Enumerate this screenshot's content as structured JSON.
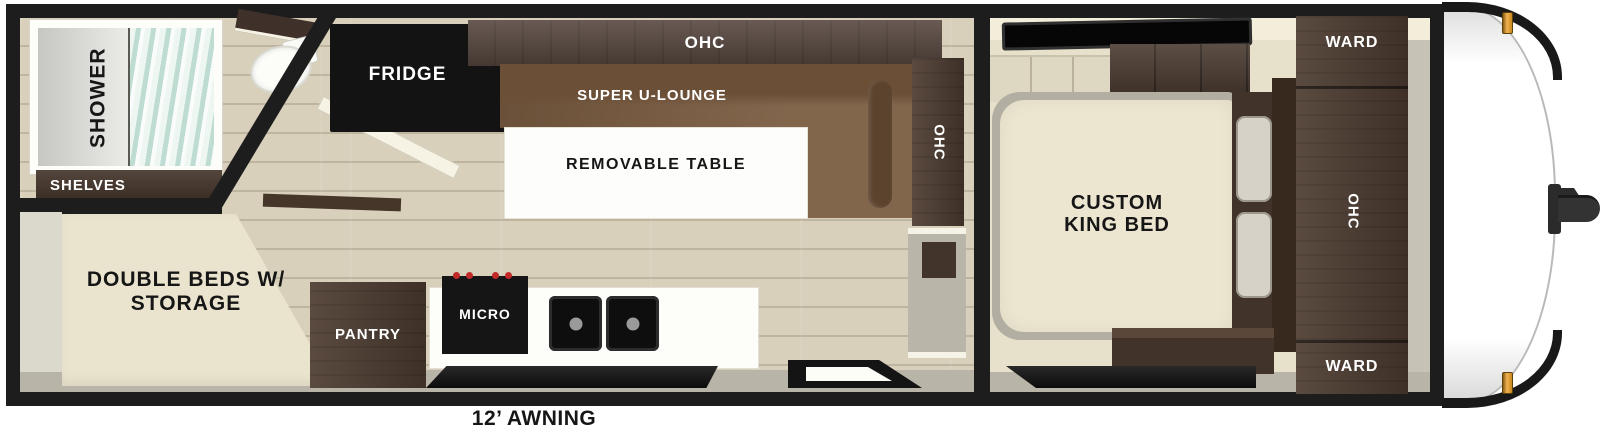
{
  "meta": {
    "subject": "travel trailer floor plan, top-down view"
  },
  "colors": {
    "wall": "#1d1d1d",
    "interior_trim": "#f2eeda",
    "floor_wood": "#d8d0bb",
    "cabinet_wood": "#4c3b30",
    "lounge_brown": "#7a5c41",
    "bed_cream": "#ece6d0",
    "marker_amber": "#f2b352",
    "curtain_teal": "#bedcd2"
  },
  "rooms": {
    "bathroom": {
      "shower": "SHOWER",
      "shelves": "SHELVES"
    },
    "rear_bedroom": {
      "double_beds": "DOUBLE BEDS W/\nSTORAGE"
    },
    "kitchen": {
      "fridge": "FRIDGE",
      "pantry": "PANTRY",
      "micro": "MICRO"
    },
    "living": {
      "ohc_top": "OHC",
      "super_u_lounge": "SUPER U-LOUNGE",
      "removable_table": "REMOVABLE TABLE",
      "ohc_side": "OHC"
    },
    "front_bedroom": {
      "custom_king_bed": "CUSTOM\nKING BED",
      "ward_top": "WARD",
      "ohc": "OHC",
      "ward_bottom": "WARD"
    }
  },
  "exterior": {
    "awning": "12’ AWNING"
  }
}
